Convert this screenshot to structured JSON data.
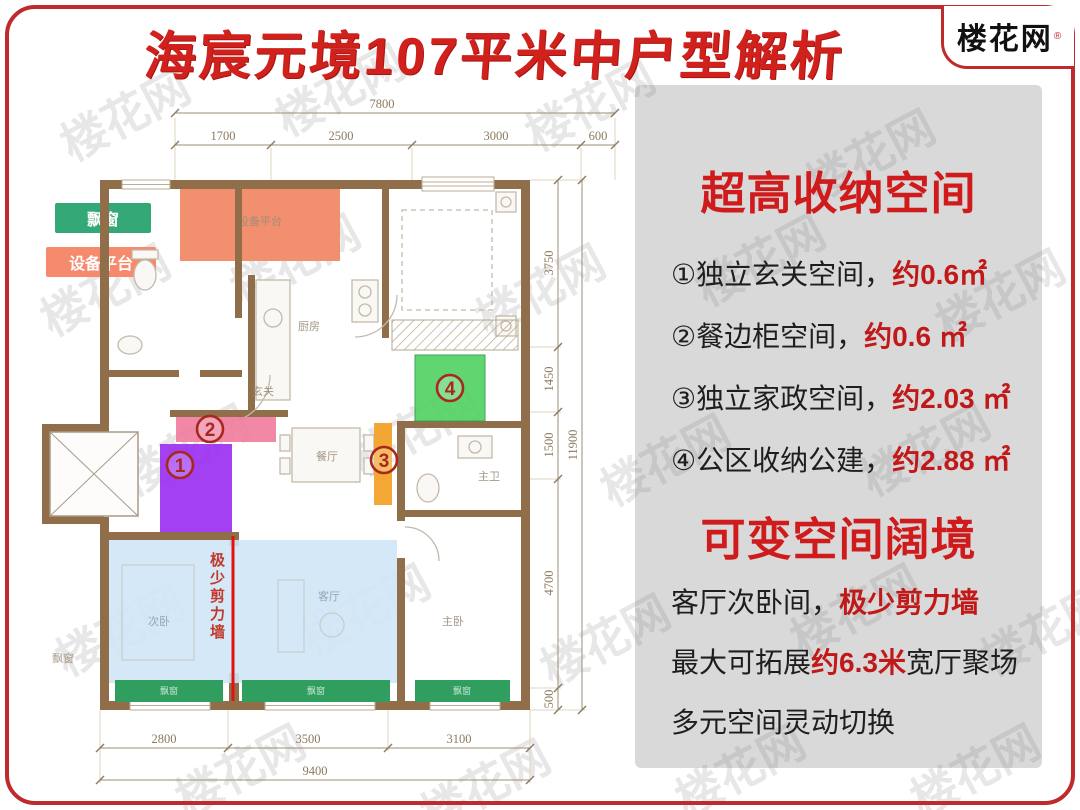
{
  "header": {
    "title": "海宸元境107平米中户型解析",
    "logo_text": "楼花网",
    "reg_mark": "®"
  },
  "watermark": {
    "text": "楼花网"
  },
  "legend": {
    "bay_window_label": "飘窗",
    "equipment_label": "设备平台"
  },
  "floorplan": {
    "dims": {
      "top": {
        "overall": "7800",
        "segments": [
          "1700",
          "2500",
          "3000",
          "600"
        ]
      },
      "bottom": {
        "overall": "9400",
        "segments": [
          "2800",
          "3500",
          "3100"
        ]
      },
      "right": {
        "overall": "11900",
        "segments": [
          "3750",
          "1450",
          "1500",
          "4700",
          "500"
        ]
      }
    },
    "labels": {
      "entry": "玄关",
      "kitchen": "厨房",
      "dining": "餐厅",
      "master_bath": "主卫",
      "master_bed": "主卧",
      "second_bed": "次卧",
      "living": "客厅",
      "bay_window": "飘窗",
      "equipment_platform": "设备平台"
    },
    "markers": [
      {
        "num": "1"
      },
      {
        "num": "2"
      },
      {
        "num": "3"
      },
      {
        "num": "4"
      }
    ],
    "shear_note": "极少剪力墙"
  },
  "panel": {
    "storage": {
      "title": "超高收纳空间",
      "items": [
        {
          "text": "①独立玄关空间，",
          "value": "约0.6㎡"
        },
        {
          "text": "②餐边柜空间，",
          "value": "约0.6 ㎡"
        },
        {
          "text": "③独立家政空间，",
          "value": "约2.03 ㎡"
        },
        {
          "text": "④公区收纳公建，",
          "value": "约2.88 ㎡"
        }
      ]
    },
    "flex": {
      "title": "可变空间阔境",
      "lines": [
        {
          "pre": "客厅次卧间，",
          "em": "极少剪力墙",
          "post": ""
        },
        {
          "pre": "最大可拓展",
          "em": "约6.3米",
          "post": "宽厅聚场"
        },
        {
          "pre": "多元空间灵动切换",
          "em": "",
          "post": ""
        }
      ]
    }
  },
  "colors": {
    "accent_red": "#d0211c",
    "panel_bg": "#d9d9d9",
    "wall_brown": "#8f6e49",
    "zone_purple": "#9b30f0",
    "zone_pink": "#f07f9e",
    "zone_orange": "#f2a229",
    "zone_green": "#54d264",
    "zone_blue": "#cfe6f6",
    "bay_green": "#2f9e5f",
    "platform_salmon": "#f58f70"
  }
}
